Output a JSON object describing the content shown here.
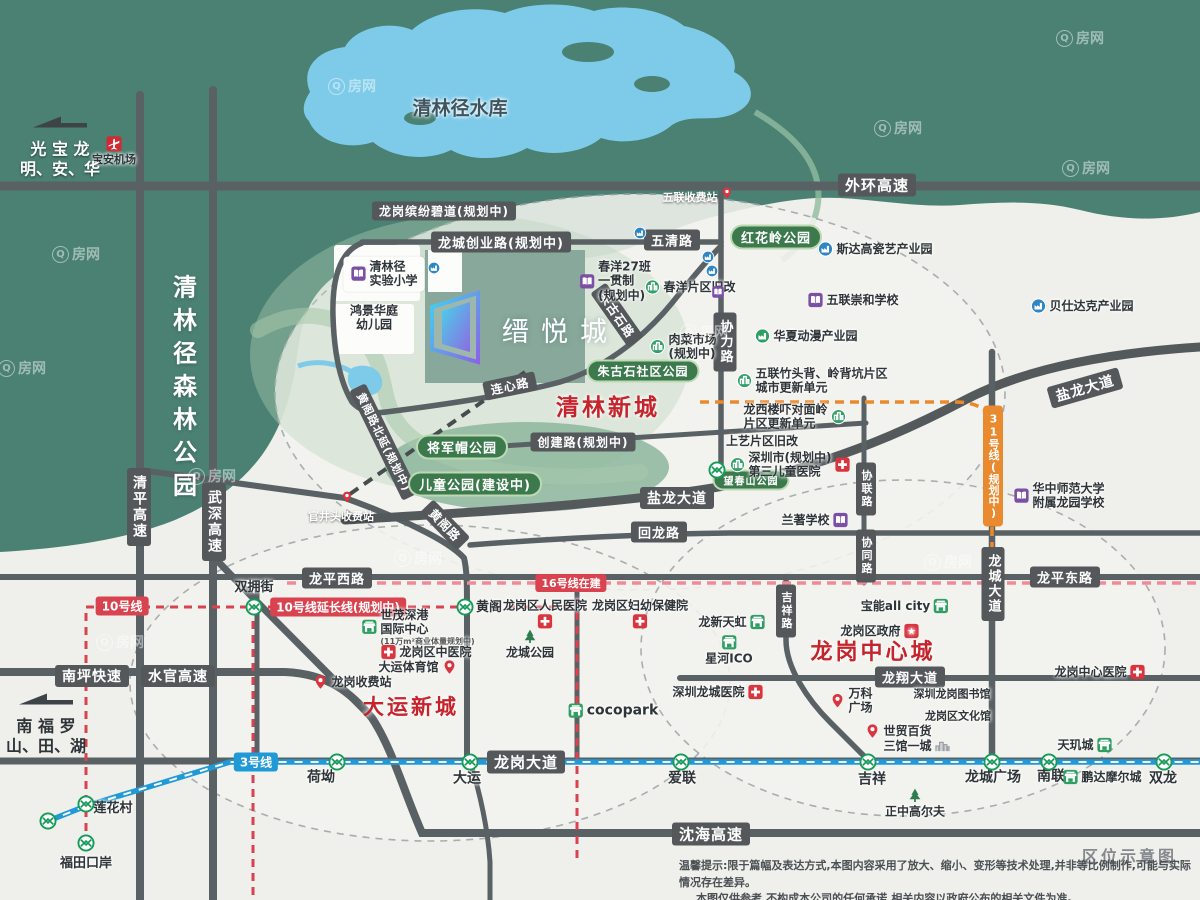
{
  "map": {
    "project": {
      "name": "缙悦城"
    },
    "notes": {
      "corner": "区位示意图",
      "disclaimer1": "温馨提示:限于篇幅及表达方式,本图内容采用了放大、缩小、变形等技术处理,并非等比例制作,可能与实际情况存在差异。",
      "disclaimer2": "本图仅供参考,不构成本公司的任何承诺,相关内容以政府公布的相关文件为准。"
    },
    "watermark": "Q房网",
    "colors": {
      "road": "#54585b",
      "park": "#3c7a4e",
      "line10": "#d9434f",
      "line16": "#ef8a97",
      "line3": "#1f9ad7",
      "line31": "#e98a2e",
      "district": "#c5242c",
      "forest": "#4a8172",
      "water": "#7ecbe9"
    },
    "labels": [
      {
        "t": "road",
        "s": "外环高速",
        "x": 877,
        "y": 185,
        "fs": 15
      },
      {
        "t": "road",
        "s": "龙岗缤纷碧道(规划中)",
        "x": 444,
        "y": 211,
        "fs": 12
      },
      {
        "t": "road",
        "s": "龙城创业路(规划中)",
        "x": 501,
        "y": 242,
        "fs": 13
      },
      {
        "t": "road",
        "s": "五清路",
        "x": 672,
        "y": 240,
        "fs": 13
      },
      {
        "t": "road",
        "s": "连心路",
        "x": 510,
        "y": 386,
        "fs": 12,
        "rot": -12
      },
      {
        "t": "road",
        "s": "朱古石路",
        "x": 617,
        "y": 315,
        "fs": 12,
        "rot": 55
      },
      {
        "t": "roadv",
        "s": "协力路",
        "x": 725,
        "y": 342,
        "fs": 13
      },
      {
        "t": "road",
        "s": "盐龙大道",
        "x": 677,
        "y": 498,
        "fs": 14
      },
      {
        "t": "road",
        "s": "盐龙大道",
        "x": 1085,
        "y": 388,
        "fs": 14,
        "rot": -16
      },
      {
        "t": "road",
        "s": "创建路(规划中)",
        "x": 583,
        "y": 442,
        "fs": 12
      },
      {
        "t": "road",
        "s": "黄阁路北延(规划中)",
        "x": 384,
        "y": 442,
        "fs": 11,
        "rot": 64
      },
      {
        "t": "road",
        "s": "黄阁路",
        "x": 445,
        "y": 525,
        "fs": 12,
        "rot": 46
      },
      {
        "t": "road",
        "s": "回龙路",
        "x": 659,
        "y": 532,
        "fs": 13
      },
      {
        "t": "road",
        "s": "龙平西路",
        "x": 337,
        "y": 578,
        "fs": 13
      },
      {
        "t": "road",
        "s": "龙平东路",
        "x": 1065,
        "y": 577,
        "fs": 13
      },
      {
        "t": "roadv",
        "s": "武深高速",
        "x": 214,
        "y": 522,
        "fs": 14
      },
      {
        "t": "roadv",
        "s": "清平高速",
        "x": 139,
        "y": 507,
        "fs": 14
      },
      {
        "t": "road",
        "s": "南坪快速",
        "x": 92,
        "y": 676,
        "fs": 14
      },
      {
        "t": "road",
        "s": "水官高速",
        "x": 178,
        "y": 676,
        "fs": 14
      },
      {
        "t": "road",
        "s": "龙岗大道",
        "x": 526,
        "y": 762,
        "fs": 15
      },
      {
        "t": "road",
        "s": "龙翔大道",
        "x": 910,
        "y": 677,
        "fs": 13
      },
      {
        "t": "road",
        "s": "沈海高速",
        "x": 711,
        "y": 834,
        "fs": 15
      },
      {
        "t": "roadv",
        "s": "龙城大道",
        "x": 993,
        "y": 584,
        "fs": 13
      },
      {
        "t": "roadv",
        "s": "协联路",
        "x": 866,
        "y": 489,
        "fs": 11
      },
      {
        "t": "roadv",
        "s": "协同路",
        "x": 866,
        "y": 556,
        "fs": 11
      },
      {
        "t": "roadv",
        "s": "吉祥路",
        "x": 786,
        "y": 611,
        "fs": 11
      },
      {
        "t": "mline",
        "s": "10号线",
        "x": 122,
        "y": 606,
        "c": "#d9434f",
        "fs": 12
      },
      {
        "t": "mline",
        "s": "10号线延长线(规划中)",
        "x": 338,
        "y": 607,
        "c": "#d9434f",
        "fs": 12
      },
      {
        "t": "mline",
        "s": "16号线在建",
        "x": 571,
        "y": 583,
        "c": "#d9434f",
        "fs": 11
      },
      {
        "t": "mline",
        "s": "3号线",
        "x": 256,
        "y": 762,
        "c": "#1f9ad7",
        "fs": 12
      },
      {
        "t": "mlinev",
        "s": "31号线(规划中)",
        "x": 993,
        "y": 466,
        "c": "#e98a2e",
        "fs": 11
      },
      {
        "t": "park",
        "s": "红花岭公园",
        "x": 776,
        "y": 237,
        "fs": 13
      },
      {
        "t": "park",
        "s": "朱古石社区公园",
        "x": 643,
        "y": 371,
        "fs": 12
      },
      {
        "t": "park",
        "s": "将军帽公园",
        "x": 462,
        "y": 447,
        "fs": 13
      },
      {
        "t": "park",
        "s": "儿童公园(建设中)",
        "x": 475,
        "y": 484,
        "fs": 13
      },
      {
        "t": "park",
        "s": "望春山公园",
        "x": 751,
        "y": 480,
        "fs": 10
      },
      {
        "t": "red",
        "s": "清林新城",
        "x": 608,
        "y": 405,
        "fs": 23
      },
      {
        "t": "red",
        "s": "大运新城",
        "x": 411,
        "y": 706,
        "fs": 21
      },
      {
        "t": "red",
        "s": "龙岗中心城",
        "x": 873,
        "y": 650,
        "fs": 22
      },
      {
        "t": "txt",
        "s": "清林径水库",
        "x": 460,
        "y": 109,
        "fs": 19,
        "c": "#3e5560"
      },
      {
        "t": "txtv",
        "s": "清林径森林公园",
        "x": 183,
        "y": 390,
        "fs": 24
      },
      {
        "t": "txt",
        "s": "双拥街",
        "x": 254,
        "y": 588,
        "fs": 13
      },
      {
        "t": "txt",
        "s": "黄阁",
        "x": 489,
        "y": 608,
        "fs": 13
      },
      {
        "t": "txtw",
        "s": "五联收费站",
        "x": 690,
        "y": 197,
        "fs": 11
      },
      {
        "t": "txtw",
        "s": "官井头收费站",
        "x": 341,
        "y": 516,
        "fs": 11
      },
      {
        "t": "txt",
        "s": "荷坳",
        "x": 321,
        "y": 778,
        "fs": 14
      },
      {
        "t": "txt",
        "s": "大运",
        "x": 467,
        "y": 779,
        "fs": 14
      },
      {
        "t": "txt",
        "s": "爱联",
        "x": 682,
        "y": 779,
        "fs": 14
      },
      {
        "t": "txt",
        "s": "吉祥",
        "x": 872,
        "y": 780,
        "fs": 14
      },
      {
        "t": "txt",
        "s": "龙城广场",
        "x": 993,
        "y": 778,
        "fs": 14
      },
      {
        "t": "txt",
        "s": "南联",
        "x": 1051,
        "y": 777,
        "fs": 14
      },
      {
        "t": "txt",
        "s": "双龙",
        "x": 1163,
        "y": 779,
        "fs": 14
      },
      {
        "t": "txt",
        "s": "莲花村",
        "x": 113,
        "y": 809,
        "fs": 13
      },
      {
        "t": "txt",
        "s": "福田口岸",
        "x": 86,
        "y": 864,
        "fs": 13
      },
      {
        "t": "txt",
        "s": "上艺片区旧改",
        "x": 762,
        "y": 441,
        "fs": 12
      },
      {
        "t": "txt",
        "s": "深圳龙岗图书馆",
        "x": 952,
        "y": 694,
        "fs": 11
      },
      {
        "t": "txt",
        "s": "龙岗区文化馆",
        "x": 958,
        "y": 716,
        "fs": 11
      },
      {
        "t": "txt",
        "s": [
          "鸿景华庭",
          "幼儿园"
        ],
        "x": 374,
        "y": 318,
        "fs": 12
      },
      {
        "t": "poi",
        "icon": "school",
        "s": [
          "清林径",
          "实验小学"
        ],
        "x": 384,
        "y": 274,
        "fs": 12,
        "bg": 1
      },
      {
        "t": "poi",
        "icon": "school",
        "s": [
          "春洋27班",
          "一贯制",
          "(规划中)"
        ],
        "x": 615,
        "y": 281,
        "fs": 12
      },
      {
        "t": "poi",
        "icon": "renew",
        "s": "春洋片区旧改",
        "x": 690,
        "y": 287,
        "fs": 12
      },
      {
        "t": "poi",
        "icon": "renew",
        "s": [
          "肉菜市场",
          "(规划中)"
        ],
        "x": 683,
        "y": 347,
        "fs": 12
      },
      {
        "t": "poi",
        "icon": "ind",
        "s": "斯达高瓷艺产业园",
        "x": 875,
        "y": 249,
        "fs": 12
      },
      {
        "t": "poi",
        "icon": "school",
        "s": "五联崇和学校",
        "x": 853,
        "y": 300,
        "fs": 12
      },
      {
        "t": "poi",
        "icon": "ind2",
        "s": "华夏动漫产业园",
        "x": 806,
        "y": 336,
        "fs": 12
      },
      {
        "t": "poi",
        "icon": "ind",
        "s": "贝仕达克产业园",
        "x": 1082,
        "y": 306,
        "fs": 12
      },
      {
        "t": "poi",
        "icon": "renew",
        "s": [
          "五联竹头背、岭背坑片区",
          "城市更新单元"
        ],
        "x": 812,
        "y": 381,
        "fs": 12
      },
      {
        "t": "poi",
        "icon": "renew",
        "side": "r",
        "s": [
          "龙西楼吓对面岭",
          "片区更新单元"
        ],
        "x": 795,
        "y": 417,
        "fs": 12
      },
      {
        "t": "poi",
        "icon": "renew",
        "icon2": "hosp",
        "s": [
          "深圳市(规划中)",
          "第三儿童医院"
        ],
        "x": 790,
        "y": 465,
        "fs": 12
      },
      {
        "t": "poi",
        "icon": "school",
        "side": "r",
        "s": "兰著学校",
        "x": 815,
        "y": 520,
        "fs": 12
      },
      {
        "t": "poi",
        "icon": "school",
        "s": [
          "华中师范大学",
          "附属龙园学校"
        ],
        "x": 1059,
        "y": 496,
        "fs": 12
      },
      {
        "t": "poi",
        "icon": "shop",
        "s": [
          "世茂深港",
          "国际中心"
        ],
        "sub": "(11万m²商业体量规划中)",
        "x": 418,
        "y": 627,
        "fs": 12
      },
      {
        "t": "poi",
        "icon": "hosp",
        "s": "龙岗区中医院",
        "x": 426,
        "y": 652,
        "fs": 12
      },
      {
        "t": "poi",
        "icon": "pin",
        "side": "r",
        "s": "大运体育馆",
        "x": 418,
        "y": 667,
        "fs": 12
      },
      {
        "t": "poi",
        "icon": "pin",
        "s": "龙岗收费站",
        "x": 352,
        "y": 682,
        "fs": 12
      },
      {
        "t": "poi",
        "icon": "tree",
        "side": "t",
        "s": "龙城公园",
        "x": 530,
        "y": 644,
        "fs": 12
      },
      {
        "t": "poi",
        "icon": "hosp",
        "side": "b",
        "s": "龙岗区人民医院",
        "x": 545,
        "y": 614,
        "fs": 12
      },
      {
        "t": "poi",
        "icon": "hosp",
        "side": "b",
        "s": "龙岗区妇幼保健院",
        "x": 640,
        "y": 614,
        "fs": 12
      },
      {
        "t": "poi",
        "icon": "shop",
        "s": "cocopark",
        "x": 613,
        "y": 711,
        "fs": 14
      },
      {
        "t": "poi",
        "icon": "shop",
        "side": "r",
        "s": "龙新天虹",
        "x": 732,
        "y": 622,
        "fs": 12
      },
      {
        "t": "poi",
        "icon": "shop",
        "side": "t",
        "s": "星河ICO",
        "x": 729,
        "y": 650,
        "fs": 12
      },
      {
        "t": "poi",
        "icon": "shop",
        "side": "r",
        "s": "宝能all city",
        "x": 905,
        "y": 606,
        "fs": 12
      },
      {
        "t": "poi",
        "icon": "gov",
        "side": "r",
        "s": "龙岗区政府",
        "x": 880,
        "y": 631,
        "fs": 12
      },
      {
        "t": "poi",
        "icon": "hosp",
        "side": "r",
        "s": "深圳龙城医院",
        "x": 718,
        "y": 692,
        "fs": 12
      },
      {
        "t": "poi",
        "icon": "pin",
        "s": [
          "万科",
          "广场"
        ],
        "x": 851,
        "y": 701,
        "fs": 12
      },
      {
        "t": "poi",
        "icon": "pin",
        "s": "世贸百货",
        "x": 898,
        "y": 731,
        "fs": 12
      },
      {
        "t": "poi",
        "icon": "bld",
        "side": "r",
        "s": "三馆一城",
        "x": 917,
        "y": 746,
        "fs": 12
      },
      {
        "t": "poi",
        "icon": "hosp",
        "side": "r",
        "s": "龙岗中心医院",
        "x": 1100,
        "y": 672,
        "fs": 12
      },
      {
        "t": "poi",
        "icon": "shop",
        "side": "r",
        "s": "天玑城",
        "x": 1085,
        "y": 745,
        "fs": 12
      },
      {
        "t": "poi",
        "icon": "shop",
        "s": "鹏达摩尔城",
        "x": 1102,
        "y": 777,
        "fs": 12
      },
      {
        "t": "poi",
        "icon": "tree",
        "side": "t",
        "s": "正中高尔夫",
        "x": 915,
        "y": 803,
        "fs": 12
      },
      {
        "t": "poi",
        "icon": "air",
        "side": "t",
        "s": "宝安机场",
        "x": 114,
        "y": 151,
        "fs": 11,
        "wt": 1
      },
      {
        "t": "arrow",
        "s": [
          "光 宝 龙",
          "明、安、华"
        ],
        "x": 60,
        "y": 147,
        "wt": 1
      },
      {
        "t": "arrow",
        "s": [
          "南 福 罗",
          "山、田、湖"
        ],
        "x": 46,
        "y": 724
      }
    ],
    "stations": [
      [
        254,
        607
      ],
      [
        465,
        607
      ],
      [
        337,
        762
      ],
      [
        470,
        762
      ],
      [
        681,
        762
      ],
      [
        868,
        762
      ],
      [
        992,
        762
      ],
      [
        1049,
        762
      ],
      [
        1164,
        762
      ],
      [
        86,
        804
      ],
      [
        48,
        821
      ],
      [
        86,
        843
      ],
      [
        717,
        470
      ]
    ],
    "minis": [
      {
        "k": "ind",
        "x": 434,
        "y": 268
      },
      {
        "k": "ind",
        "x": 640,
        "y": 233
      },
      {
        "k": "ind",
        "x": 708,
        "y": 257
      },
      {
        "k": "ind",
        "x": 712,
        "y": 271
      },
      {
        "k": "school",
        "x": 718,
        "y": 292
      },
      {
        "k": "pin",
        "x": 727,
        "y": 193
      },
      {
        "k": "pin",
        "x": 347,
        "y": 497
      }
    ],
    "watermarks": [
      [
        352,
        86
      ],
      [
        1080,
        38
      ],
      [
        898,
        128
      ],
      [
        1086,
        168
      ],
      [
        76,
        254
      ],
      [
        22,
        368
      ],
      [
        212,
        476
      ],
      [
        704,
        332
      ],
      [
        418,
        558
      ],
      [
        948,
        562
      ],
      [
        120,
        642
      ]
    ]
  }
}
